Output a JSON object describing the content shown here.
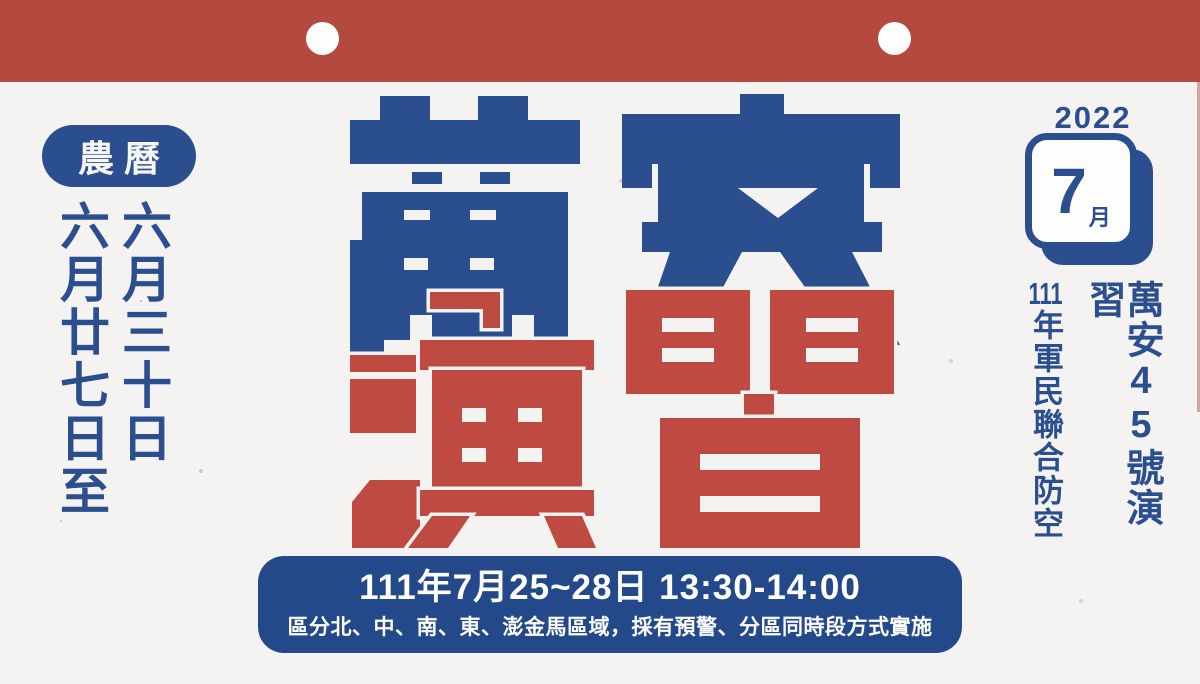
{
  "poster": {
    "lunar": {
      "badge_label": "農曆",
      "range_start": "六月廿七日至",
      "range_end": "六月三十日"
    },
    "title": {
      "word_top": "萬安",
      "word_bottom": "演習",
      "chars": [
        "萬",
        "安",
        "演",
        "習"
      ]
    },
    "calendar": {
      "year": "2022",
      "month_big": "7",
      "month_unit": "月"
    },
    "right_info": {
      "exercise_name": "萬安45號演習",
      "subtitle_prefix": "111",
      "subtitle_rest": "年軍民聯合防空"
    },
    "banner": {
      "schedule": "111年7月25~28日 13:30-14:00",
      "details": "區分北、中、南、東、澎金馬區域，採有預警、分區同時段方式實施"
    }
  },
  "colors": {
    "header_red": "#b4493f",
    "glyph_red": "#bf4a41",
    "glyph_blue": "#2b4e8f",
    "banner_blue": "#23498b",
    "paper": "#f4f3f1",
    "white": "#ffffff"
  }
}
